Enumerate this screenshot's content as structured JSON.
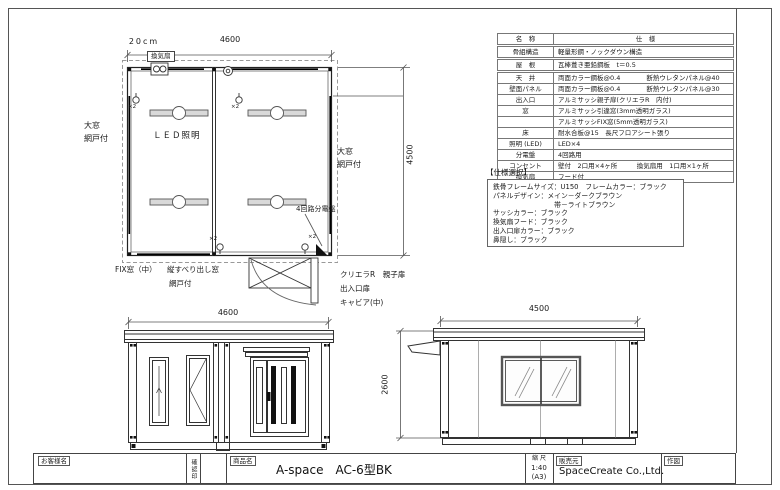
{
  "colors": {
    "paper": "#ffffff",
    "line": "#333333"
  },
  "plan": {
    "dim_width": "4600",
    "dim_height": "4500",
    "vent_dim": "20cm",
    "vent_label": "換気扇",
    "led_label": "ＬＥＤ照明",
    "outlet_note": "×2",
    "big_window_1": "大窓",
    "big_window_2": "網戸付",
    "panel_label": "4回路分電盤",
    "fix_window_label": "FIX窓（中）",
    "casement_label_1": "縦すべり出し窓",
    "casement_label_2": "網戸付",
    "door_label_1": "クリエラR　親子扉",
    "door_label_2": "出入口扉",
    "door_label_3": "キャビア(中)"
  },
  "front_elevation": {
    "dim_width": "4600"
  },
  "side_elevation": {
    "dim_width": "4500",
    "dim_height": "2600"
  },
  "spec_table": {
    "headers": {
      "name": "名　称",
      "spec": "仕　様"
    },
    "rows": [
      {
        "name": "骨組構造",
        "spec": "軽量形鋼・ノックダウン構造"
      },
      {
        "name": "屋　根",
        "spec": "瓦棒葺き亜鉛鋼板　t＝0.5"
      },
      {
        "name": "天　井",
        "spec": "両面カラー鋼板@0.4　　　　断熱ウレタンパネル@40"
      },
      {
        "name": "壁面パネル",
        "spec": "両面カラー鋼板@0.4　　　　断熱ウレタンパネル@30"
      },
      {
        "name": "出入口",
        "spec": "アルミサッシ親子扉(クリエラR　内付)"
      },
      {
        "name": "窓",
        "spec": "アルミサッシ引違窓(3mm透明ガラス)"
      },
      {
        "name": "",
        "spec": "アルミサッシFIX窓(5mm透明ガラス)"
      },
      {
        "name": "床",
        "spec": "耐水合板@15　長尺フロアシート張り"
      },
      {
        "name": "照明 (LED)",
        "spec": "LED×4"
      },
      {
        "name": "分電盤",
        "spec": "4回路用"
      },
      {
        "name": "コンセント",
        "spec": "壁付　2口用×4ヶ所　　　換気扇用　1口用×1ヶ所"
      },
      {
        "name": "換気扇",
        "spec": "フード付"
      }
    ]
  },
  "spec_select": {
    "title": "【仕様選択】",
    "lines": [
      "鉄骨フレームサイズ：U150　フレームカラー：ブラック",
      "パネルデザイン：メイン－ダークブラウン",
      "　　　　　　　　　帯－ライトブラウン",
      "サッシカラー：ブラック",
      "換気扇フード：ブラック",
      "出入口扉カラー：ブラック",
      "鼻隠し：ブラック"
    ]
  },
  "sheet": {
    "titleblock": {
      "customer_label": "お客様名",
      "stamp_label": "確認印",
      "product_label": "商品名",
      "product_name": "A-space　AC-6型BK",
      "scale_label": "縮 尺",
      "scale_value": "1:40",
      "paper_size": "(A3)",
      "seller_label": "販売元",
      "seller_name": "SpaceCreate Co.,Ltd.",
      "drawn_by_label": "作図"
    }
  }
}
